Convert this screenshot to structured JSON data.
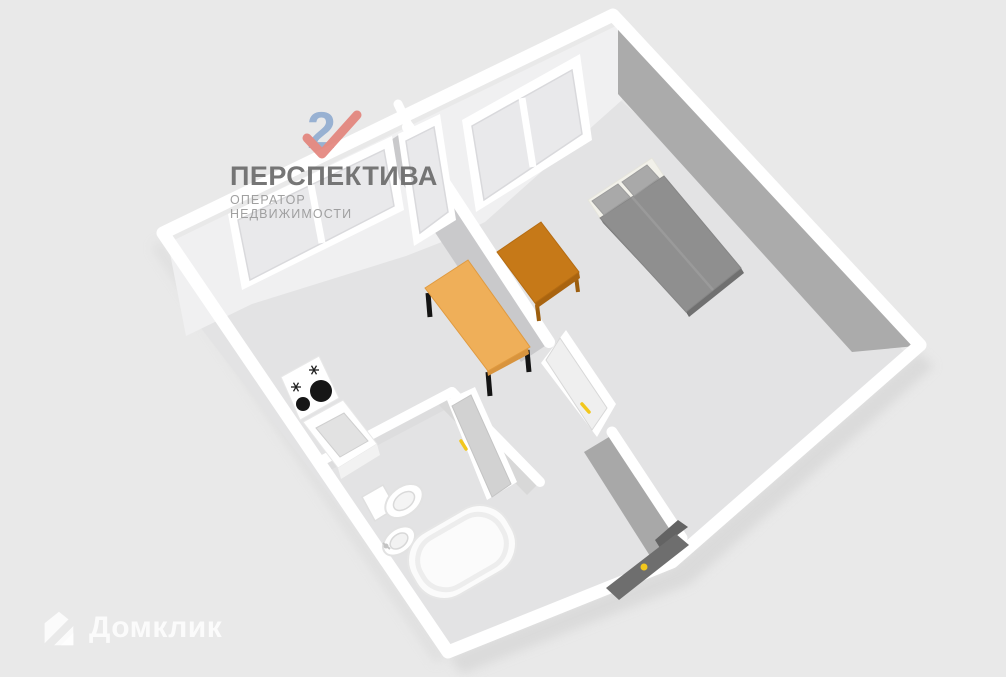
{
  "scene": {
    "type": "3d_floorplan_render",
    "rooms": [
      {
        "name": "kitchen",
        "furniture": [
          "stove-cooktop-2-burners",
          "sink-cabinet",
          "dining-table",
          "double-window",
          "balcony-door"
        ]
      },
      {
        "name": "bedroom",
        "furniture": [
          "double-bed-2-pillows",
          "desk-table",
          "double-window"
        ]
      },
      {
        "name": "hallway",
        "furniture": [
          "interior-door",
          "entrance-door"
        ]
      },
      {
        "name": "bathroom",
        "furniture": [
          "toilet",
          "washbasin",
          "bathtub",
          "bathroom-door"
        ]
      }
    ]
  },
  "colors": {
    "background": "#E9E9E9",
    "floor": "#E3E3E4",
    "wall_top": "#FFFFFF",
    "wall_face_light": "#F0F0F1",
    "wall_face_dark": "#ABABAB",
    "divider_face": "#C9C9CB",
    "divider_face_dark": "#A8A8A8",
    "glass": "#E9E9EB",
    "kitchen_table": "#EFAF59",
    "kitchen_table_edge": "#D8943E",
    "desk": "#C67918",
    "desk_edge": "#A96410",
    "bed": "#8F8F8F",
    "pillow": "#A9A9A9",
    "sheet": "#F2F1EA",
    "door_handle": "#F2C71D",
    "entrance_door": "#6E6E6E",
    "interior_door": "#EFEFEF",
    "bathroom_door": "#D2D2D2",
    "burner": "#161616"
  },
  "watermarks": {
    "perspektiva": {
      "title": "ПЕРСПЕКТИВА",
      "subtitle": "ОПЕРАТОР НЕДВИЖИМОСТИ",
      "icon": "numeral-2-with-checkmark-icon",
      "title_color": "#6F6F6F",
      "subtitle_color": "#9C9C9C",
      "icon_blue": "#8CA9CF",
      "icon_red": "#E27E76"
    },
    "domclick": {
      "label": "Домклик",
      "icon": "house-icon",
      "color": "rgba(255,255,255,0.82)"
    }
  }
}
